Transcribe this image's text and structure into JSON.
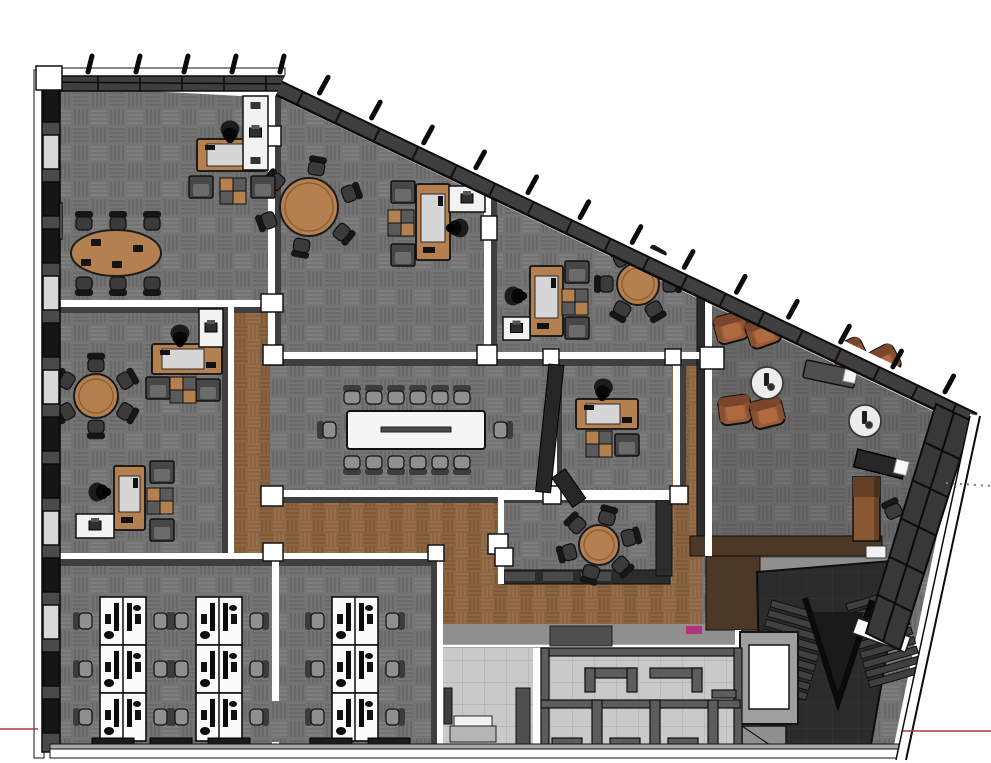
{
  "app": {
    "view_label": "office-floorplan-3d-model"
  },
  "palette": {
    "bg": "#ffffff",
    "carpet": "#747474",
    "carpet_dark": "#626262",
    "carpet_light": "#848484",
    "wood": "#8b6543",
    "wood_dark": "#76522f",
    "wood_light": "#9d764e",
    "tile": "#c9c9c9",
    "tile_line": "#b4b4b4",
    "wall_white": "#ffffff",
    "wall_shadow": "#3f3f3f",
    "band_dark": "#3f3f3f",
    "glass": "#161616",
    "pane_light": "#c6c6c6",
    "stair_bg": "#2b2b2b",
    "stair_line": "#373737",
    "step": "#404040",
    "furn_wood": "#b5804f",
    "chair_dark": "#3b3b3b",
    "chair_gray": "#8f8f8f",
    "lounge_brown": "#9a5c38",
    "lounge_brown_dark": "#7a452a",
    "lounge_brown_light": "#b06a40",
    "white_table": "#f5f5f5",
    "desk_top": "#d6d6d6",
    "axis_red": "#b03a33",
    "guide_gray": "#8a7a76",
    "magenta": "#b5307d",
    "brown_wall": "#4b3827",
    "brown_wall2": "#463524",
    "gray_walk": "#8f8f8f"
  },
  "scene": {
    "outline": [
      [
        56,
        86
      ],
      [
        279,
        98
      ],
      [
        960,
        424
      ],
      [
        893,
        750
      ],
      [
        58,
        748
      ]
    ],
    "lounge_overlay": [
      [
        712,
        292
      ],
      [
        946,
        416
      ],
      [
        868,
        632
      ],
      [
        712,
        556
      ]
    ],
    "wood_floors": [
      [
        232,
        303,
        38,
        253
      ],
      [
        232,
        497,
        268,
        59
      ],
      [
        440,
        497,
        62,
        131
      ],
      [
        440,
        583,
        258,
        45
      ],
      [
        672,
        352,
        30,
        280
      ]
    ],
    "tile_floors": [
      [
        441,
        648,
        92,
        108
      ],
      [
        541,
        648,
        199,
        108
      ]
    ],
    "gray_areas": [
      [
        441,
        624,
        299,
        24
      ],
      [
        757,
        558,
        148,
        16
      ]
    ],
    "brown_walls": [
      [
        690,
        536,
        192,
        20
      ],
      [
        706,
        556,
        54,
        74
      ]
    ],
    "white_walls": [
      [
        44,
        300,
        218,
        7
      ],
      [
        268,
        96,
        7,
        258
      ],
      [
        484,
        186,
        7,
        166
      ],
      [
        268,
        352,
        446,
        7
      ],
      [
        551,
        359,
        6,
        132
      ],
      [
        673,
        359,
        7,
        130
      ],
      [
        705,
        288,
        7,
        268
      ],
      [
        268,
        490,
        414,
        7
      ],
      [
        228,
        303,
        6,
        252
      ],
      [
        52,
        553,
        391,
        6
      ],
      [
        272,
        559,
        7,
        142
      ],
      [
        272,
        742,
        7,
        10
      ],
      [
        437,
        559,
        6,
        198
      ],
      [
        498,
        494,
        176,
        6
      ],
      [
        498,
        500,
        6,
        84
      ],
      [
        533,
        648,
        8,
        108
      ],
      [
        735,
        630,
        6,
        128
      ]
    ],
    "shadow_walls": [
      [
        44,
        307,
        218,
        6
      ],
      [
        275,
        96,
        6,
        258
      ],
      [
        491,
        186,
        6,
        166
      ],
      [
        268,
        359,
        446,
        7
      ],
      [
        268,
        497,
        414,
        6
      ],
      [
        222,
        303,
        6,
        252
      ],
      [
        52,
        559,
        391,
        7
      ],
      [
        431,
        559,
        6,
        198
      ],
      [
        557,
        359,
        5,
        132
      ],
      [
        680,
        359,
        6,
        130
      ]
    ],
    "dark_walls": [
      [
        697,
        288,
        8,
        268
      ],
      [
        502,
        570,
        168,
        14
      ],
      [
        656,
        500,
        16,
        76
      ]
    ],
    "columns": [
      [
        261,
        294,
        22,
        18
      ],
      [
        263,
        345,
        20,
        20
      ],
      [
        261,
        486,
        22,
        20
      ],
      [
        477,
        345,
        20,
        20
      ],
      [
        543,
        486,
        18,
        18
      ],
      [
        670,
        486,
        18,
        18
      ],
      [
        543,
        349,
        16,
        16
      ],
      [
        665,
        349,
        16,
        16
      ],
      [
        700,
        347,
        24,
        22
      ],
      [
        263,
        543,
        20,
        18
      ],
      [
        428,
        545,
        16,
        16
      ],
      [
        488,
        534,
        20,
        20
      ],
      [
        481,
        216,
        16,
        24
      ],
      [
        265,
        126,
        16,
        20
      ],
      [
        44,
        203,
        18,
        36
      ],
      [
        495,
        548,
        18,
        18
      ]
    ],
    "edges": {
      "top_band": {
        "x": 36,
        "y": 68,
        "w": 249,
        "h": 30
      },
      "diag": {
        "x1": 283,
        "y1": 80,
        "x2": 978,
        "y2": 412,
        "rungs": 18,
        "ticks": 13
      },
      "top_ticks": 5,
      "right_edge": {
        "x1": 975,
        "y1": 415,
        "x2": 901,
        "y2": 760
      },
      "bottom_band": {
        "x": 50,
        "y": 744,
        "w": 853
      },
      "left_band": {
        "x": 34,
        "y": 70,
        "h": 688
      },
      "left_blocks_y0": 88,
      "left_blocks_step": 47,
      "left_blocks": [
        "#161616",
        "#d8d8d8",
        "#161616",
        "#161616",
        "#d8d8d8",
        "#161616",
        "#d8d8d8",
        "#161616",
        "#161616",
        "#d8d8d8",
        "#161616",
        "#d8d8d8",
        "#161616",
        "#161616"
      ],
      "right_window_band": [
        [
          936,
          404
        ],
        [
          972,
          421
        ],
        [
          900,
          650
        ],
        [
          866,
          633
        ]
      ]
    },
    "furniture": {
      "round_tables": [
        {
          "name": "round-meeting-table-north",
          "cx": 309,
          "cy": 207,
          "r": 29,
          "chairs": 6,
          "ring": 44,
          "start": -80
        },
        {
          "name": "round-meeting-table-east",
          "cx": 638,
          "cy": 284,
          "r": 21,
          "chairs": 6,
          "ring": 33,
          "start": -60
        },
        {
          "name": "round-meeting-table-west",
          "cx": 96,
          "cy": 396,
          "r": 22,
          "chairs": 6,
          "ring": 35,
          "start": -90
        },
        {
          "name": "round-meeting-table-south",
          "cx": 599,
          "cy": 545,
          "r": 20,
          "chairs": 6,
          "ring": 32,
          "start": -75
        }
      ],
      "oval_table": {
        "name": "oval-conference-table",
        "cx": 116,
        "cy": 253,
        "rx": 45,
        "ry": 23,
        "chair_xs": [
          84,
          118,
          152
        ],
        "chair_top_y": 222,
        "chair_bottom_y": 285,
        "laptops": [
          [
            96,
            242
          ],
          [
            138,
            248
          ],
          [
            117,
            264
          ],
          [
            86,
            262
          ]
        ]
      },
      "conference_table": {
        "name": "boardroom-table",
        "x": 347,
        "y": 411,
        "w": 138,
        "h": 38,
        "top_xs": [
          352,
          374,
          396,
          418,
          440,
          462
        ],
        "chair_top_y": 396,
        "chair_bottom_y": 464,
        "end_left": [
          328,
          430
        ],
        "end_right": [
          502,
          430
        ]
      },
      "desks": [
        {
          "name": "office-desk-a",
          "x": 197,
          "y": 139,
          "w": 70,
          "h": 32,
          "dir": "h",
          "person": [
            230,
            132
          ],
          "prot": 0
        },
        {
          "name": "office-desk-b",
          "x": 416,
          "y": 184,
          "w": 34,
          "h": 76,
          "dir": "v",
          "person": [
            457,
            228
          ],
          "prot": 90
        },
        {
          "name": "office-desk-c",
          "x": 530,
          "y": 266,
          "w": 33,
          "h": 70,
          "dir": "v",
          "person": [
            516,
            296
          ],
          "prot": -90
        },
        {
          "name": "office-desk-d",
          "x": 152,
          "y": 344,
          "w": 70,
          "h": 30,
          "dir": "h",
          "person": [
            180,
            336
          ],
          "prot": 0
        },
        {
          "name": "office-desk-d2",
          "x": 114,
          "y": 466,
          "w": 31,
          "h": 64,
          "dir": "v",
          "person": [
            100,
            492
          ],
          "prot": -90
        },
        {
          "name": "office-desk-e",
          "x": 576,
          "y": 399,
          "w": 62,
          "h": 30,
          "dir": "h",
          "person": [
            603,
            390
          ],
          "prot": 8
        }
      ],
      "armchairs": [
        [
          189,
          176
        ],
        [
          251,
          176
        ],
        [
          391,
          181
        ],
        [
          391,
          244
        ],
        [
          565,
          261
        ],
        [
          565,
          317
        ],
        [
          146,
          377
        ],
        [
          196,
          379
        ],
        [
          150,
          461
        ],
        [
          150,
          519
        ],
        [
          615,
          434
        ]
      ],
      "cabinets": [
        [
          220,
          178
        ],
        [
          388,
          210
        ],
        [
          562,
          289
        ],
        [
          170,
          377
        ],
        [
          147,
          488
        ],
        [
          586,
          431
        ]
      ],
      "sideboards": [
        {
          "x": 243,
          "y": 96,
          "w": 25,
          "h": 74
        },
        {
          "x": 199,
          "y": 309,
          "w": 24,
          "h": 38
        },
        {
          "x": 449,
          "y": 186,
          "w": 36,
          "h": 26
        },
        {
          "x": 76,
          "y": 514,
          "w": 38,
          "h": 24
        },
        {
          "x": 503,
          "y": 317,
          "w": 27,
          "h": 23
        }
      ],
      "desk_banks": {
        "unit_w": 46,
        "unit_h": 48,
        "rows": 3,
        "banks": [
          [
            100,
            597
          ],
          [
            196,
            597
          ],
          [
            332,
            597
          ]
        ]
      },
      "floor_mats": [
        [
          92,
          738
        ],
        [
          150,
          738
        ],
        [
          208,
          738
        ],
        [
          310,
          738
        ],
        [
          368,
          738
        ]
      ],
      "lounge": {
        "chairs": [
          [
            731,
            327,
            -15
          ],
          [
            763,
            331,
            -20
          ],
          [
            849,
            354,
            -25
          ],
          [
            882,
            361,
            -28
          ],
          [
            735,
            409,
            -8
          ],
          [
            767,
            412,
            -14
          ]
        ],
        "tables": [
          [
            767,
            383
          ],
          [
            865,
            421
          ]
        ],
        "console": {
          "x": 830,
          "y": 374,
          "rot": 12
        },
        "tv": {
          "x": 880,
          "y": 464,
          "rot": 14
        },
        "tall_cabinet": {
          "x": 853,
          "y": 477
        },
        "desk_chair": {
          "x": 893,
          "y": 510,
          "rot": -25
        }
      },
      "door_slabs": [
        {
          "x": 549,
          "y": 364,
          "w": 15,
          "h": 128,
          "rot": 6
        },
        {
          "x": 552,
          "y": 478,
          "w": 16,
          "h": 36,
          "rot": -35
        }
      ]
    },
    "service": {
      "elevator": {
        "x": 740,
        "y": 632,
        "w": 58,
        "h": 92
      },
      "stairs": {
        "region": [
          [
            757,
            572
          ],
          [
            903,
            560
          ],
          [
            869,
            756
          ],
          [
            761,
            756
          ]
        ],
        "flight1": {
          "x": 772,
          "y": 600,
          "rot": 16,
          "wd": 60
        },
        "flight2": {
          "x": 846,
          "y": 604,
          "rot": -16,
          "wd": 56
        },
        "rail": [
          [
            805,
            598
          ],
          [
            838,
            702
          ],
          [
            872,
            600
          ]
        ],
        "landing": {
          "x": 858,
          "y": 618,
          "rot": 20,
          "w": 56,
          "h": 16
        },
        "patch": {
          "x": 866,
          "y": 546,
          "w": 20,
          "h": 12
        }
      },
      "restroom_partitions": [
        [
          541,
          648,
          199,
          8
        ],
        [
          541,
          648,
          8,
          108
        ],
        [
          734,
          648,
          8,
          108
        ],
        [
          585,
          668,
          52,
          10
        ],
        [
          585,
          668,
          10,
          24
        ],
        [
          627,
          668,
          10,
          24
        ],
        [
          650,
          668,
          52,
          10
        ],
        [
          692,
          668,
          10,
          24
        ],
        [
          712,
          690,
          24,
          8
        ],
        [
          541,
          700,
          199,
          8
        ],
        [
          592,
          700,
          10,
          56
        ],
        [
          650,
          700,
          10,
          56
        ],
        [
          708,
          700,
          10,
          56
        ],
        [
          552,
          738,
          30,
          18
        ],
        [
          610,
          738,
          30,
          18
        ],
        [
          668,
          738,
          30,
          18
        ]
      ],
      "entry": {
        "post": [
          444,
          688,
          8,
          36
        ],
        "wedge": [
          516,
          688,
          14,
          68
        ],
        "step1": [
          450,
          726,
          46,
          16
        ],
        "step2": [
          454,
          716,
          38,
          10
        ]
      },
      "dark_trapezoid": [
        550,
        626,
        62,
        20
      ],
      "magenta_mark": [
        686,
        626,
        16,
        8
      ]
    },
    "axes": {
      "red_left": [
        0,
        729,
        38,
        729
      ],
      "red_right": [
        903,
        731,
        991,
        731
      ],
      "dotted": [
        946,
        483,
        991,
        486
      ]
    }
  }
}
